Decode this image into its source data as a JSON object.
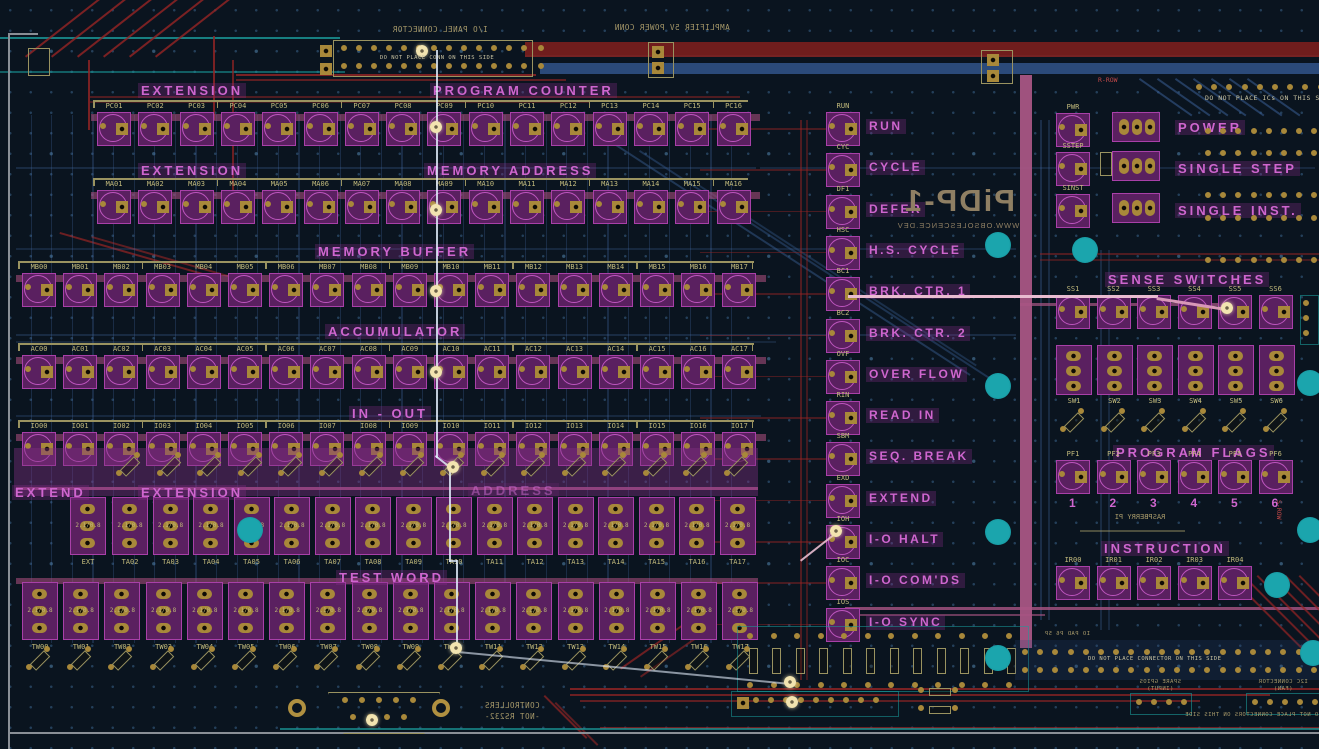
{
  "section_labels": {
    "extension_pc": "EXTENSION",
    "program_counter": "PROGRAM COUNTER",
    "extension_ma": "EXTENSION",
    "memory_address": "MEMORY ADDRESS",
    "memory_buffer": "MEMORY BUFFER",
    "accumulator": "ACCUMULATOR",
    "in_out": "IN - OUT",
    "extend_sw": "EXTEND",
    "extension_sw": "EXTENSION",
    "address_sw": "ADDRESS",
    "test_word": "TEST WORD",
    "sense_switches": "SENSE SWITCHES",
    "program_flags": "PROGRAM FLAGS",
    "instruction": "INSTRUCTION",
    "power": "POWER",
    "single_step": "SINGLE STEP",
    "single_inst": "SINGLE INST."
  },
  "led_rows": {
    "pc": [
      "PC01",
      "PC02",
      "PC03",
      "PC04",
      "PC05",
      "PC06",
      "PC07",
      "PC08",
      "PC09",
      "PC10",
      "PC11",
      "PC12",
      "PC13",
      "PC14",
      "PC15",
      "PC16"
    ],
    "ma": [
      "MA01",
      "MA02",
      "MA03",
      "MA04",
      "MA05",
      "MA06",
      "MA07",
      "MA08",
      "MA09",
      "MA10",
      "MA11",
      "MA12",
      "MA13",
      "MA14",
      "MA15",
      "MA16"
    ],
    "mb": [
      "MB00",
      "MB01",
      "MB02",
      "MB03",
      "MB04",
      "MB05",
      "MB06",
      "MB07",
      "MB08",
      "MB09",
      "MB10",
      "MB11",
      "MB12",
      "MB13",
      "MB14",
      "MB15",
      "MB16",
      "MB17"
    ],
    "ac": [
      "AC00",
      "AC01",
      "AC02",
      "AC03",
      "AC04",
      "AC05",
      "AC06",
      "AC07",
      "AC08",
      "AC09",
      "AC10",
      "AC11",
      "AC12",
      "AC13",
      "AC14",
      "AC15",
      "AC16",
      "AC17"
    ],
    "io": [
      "IO00",
      "IO01",
      "IO02",
      "IO03",
      "IO04",
      "IO05",
      "IO06",
      "IO07",
      "IO08",
      "IO09",
      "IO10",
      "IO11",
      "IO12",
      "IO13",
      "IO14",
      "IO15",
      "IO16",
      "IO17"
    ]
  },
  "switch_rows": {
    "ta": [
      "EXT",
      "TA02",
      "TA03",
      "TA04",
      "TA05",
      "TA06",
      "TA07",
      "TA08",
      "TA09",
      "TA10",
      "TA11",
      "TA12",
      "TA13",
      "TA14",
      "TA15",
      "TA16",
      "TA17"
    ],
    "tw": [
      "TW00",
      "TW01",
      "TW02",
      "TW03",
      "TW04",
      "TW05",
      "TW06",
      "TW07",
      "TW08",
      "TW09",
      "TW10",
      "TW11",
      "TW12",
      "TW13",
      "TW14",
      "TW15",
      "TW16",
      "TW17"
    ]
  },
  "switch_note": "2.1/0.8",
  "status_lamps": [
    {
      "ref": "RUN",
      "label": "RUN"
    },
    {
      "ref": "CYC",
      "label": "CYCLE"
    },
    {
      "ref": "DF1",
      "label": "DEFER"
    },
    {
      "ref": "HSC",
      "label": "H.S. CYCLE"
    },
    {
      "ref": "BC1",
      "label": "BRK. CTR. 1"
    },
    {
      "ref": "BC2",
      "label": "BRK. CTR. 2"
    },
    {
      "ref": "OVF",
      "label": "OVER FLOW"
    },
    {
      "ref": "RIN",
      "label": "READ IN"
    },
    {
      "ref": "SBM",
      "label": "SEQ. BREAK"
    },
    {
      "ref": "EXD",
      "label": "EXTEND"
    },
    {
      "ref": "IOH",
      "label": "I-O HALT"
    },
    {
      "ref": "IOC",
      "label": "I-O COM'DS"
    },
    {
      "ref": "IOS",
      "label": "I-O SYNC"
    }
  ],
  "power_lamps": [
    "PWR",
    "SSTEP",
    "SINST"
  ],
  "sense": {
    "leds": [
      "SS1",
      "SS2",
      "SS3",
      "SS4",
      "SS5",
      "SS6"
    ],
    "switch_refs": [
      "SW1",
      "SW2",
      "SW3",
      "SW4",
      "SW5",
      "SW6"
    ]
  },
  "flags": {
    "leds": [
      "PF1",
      "PF2",
      "PF3",
      "PF4",
      "PF5",
      "PF6"
    ],
    "numbers": [
      "1",
      "2",
      "3",
      "4",
      "5",
      "6"
    ]
  },
  "instruction_leds": [
    "IR00",
    "IR01",
    "IR02",
    "IR03",
    "IR04"
  ],
  "mirrored_texts": {
    "io_panel": "I/O PANEL CONNECTOR",
    "amplifier": "AMPLIFIER 5V POWER CONN",
    "logo": "PiDP-1",
    "logo_url": "WWW.OBSOLESCENCE.DEV",
    "raspberry": "RASPBERRY PI",
    "controllers_line1": "CONTROLLERS",
    "controllers_line2": "-NOT RS232-",
    "spare_gpios_line1": "SPARE GPIOS",
    "spare_gpios_line2": "(INPUT)",
    "i2c_line1": "I2C CONNECTOR",
    "i2c_line2": "(FAN)",
    "pad_note": "IO PAD P6 5P",
    "no_connectors": "DO NOT PLACE CONNECTORS ON THIS SIDE"
  },
  "notes": {
    "no_ics": "DO NOT PLACE ICs ON THIS SIDE!",
    "no_connector": "DO NOT PLACE CONNECTOR ON THIS SIDE",
    "no_conn_small": "DO NOT PLACE CONN ON THIS SIDE",
    "r_row": "R-ROW",
    "s_row": "S-ROW"
  },
  "colors": {
    "background": "#0a141f",
    "copper_front": "#962424",
    "copper_back": "#35598c",
    "silk_front": "#cf66cf",
    "silk_back": "#b5ad72",
    "pad_gold": "#a8883a",
    "via_teal": "#1a9a9a",
    "highlight": "#f2e4b0",
    "rose_bus": "#aa5584",
    "band_red": "#701d1d",
    "band_blue": "#2b4a7a"
  }
}
